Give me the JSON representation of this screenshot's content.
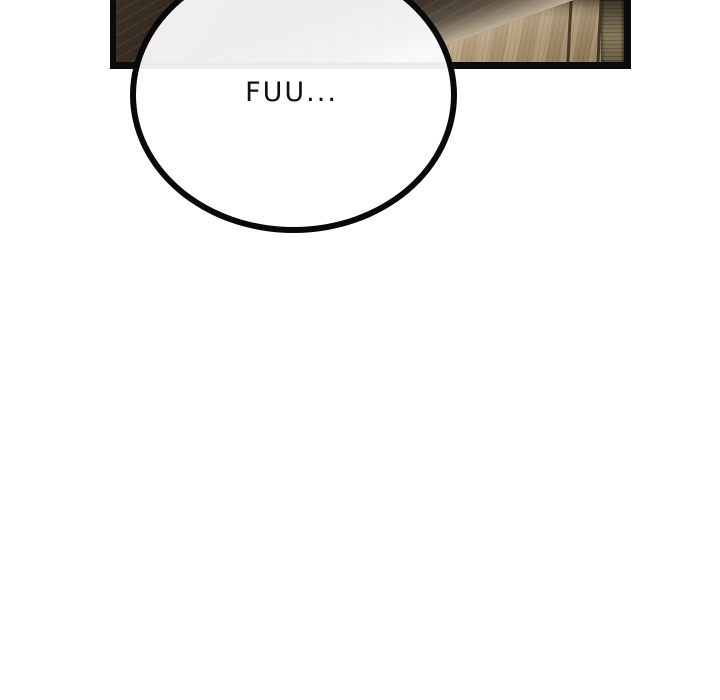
{
  "comic": {
    "bubble_text": "FUU...",
    "colors": {
      "page_background": "#ffffff",
      "panel_border": "#0c0b09",
      "wood_dark": "#261e17",
      "wood_light": "#a68e6c",
      "edge_strip": "#6b604a",
      "bubble_fill": "#ffffff",
      "bubble_stroke": "#090909",
      "text_color": "#101010"
    }
  }
}
